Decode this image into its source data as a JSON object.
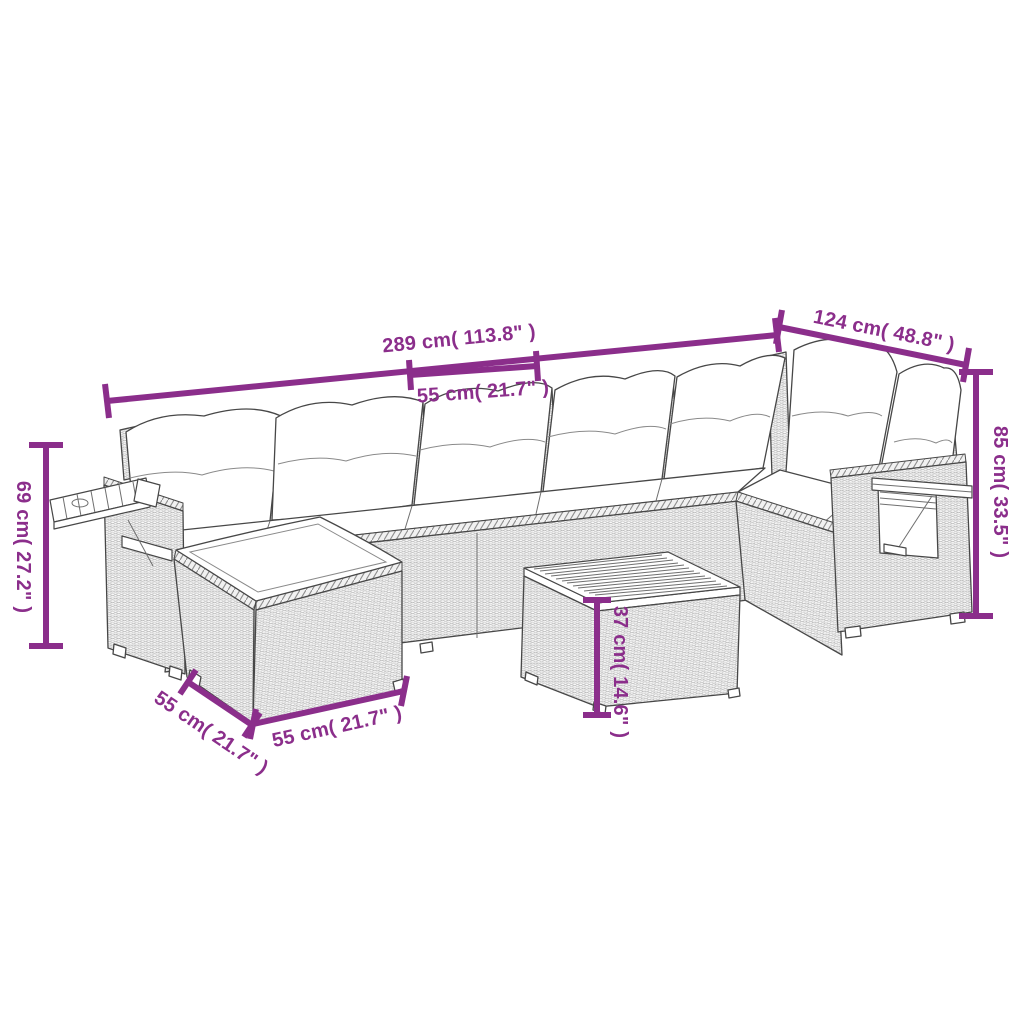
{
  "colors": {
    "dimension_accent": "#8B2E8B",
    "line_art": "#474747",
    "background": "#FFFFFF"
  },
  "dimensions": {
    "total_length": "289 cm( 113.8\" )",
    "total_depth": "124 cm( 48.8\" )",
    "seat_width": "55 cm( 21.7\" )",
    "back_height": "85 cm( 33.5\" )",
    "arm_height": "69 cm( 27.2\" )",
    "table_height": "37 cm( 14.6\" )",
    "ottoman_depth": "55 cm( 21.7\" )",
    "ottoman_width": "55 cm( 21.7\" )"
  }
}
